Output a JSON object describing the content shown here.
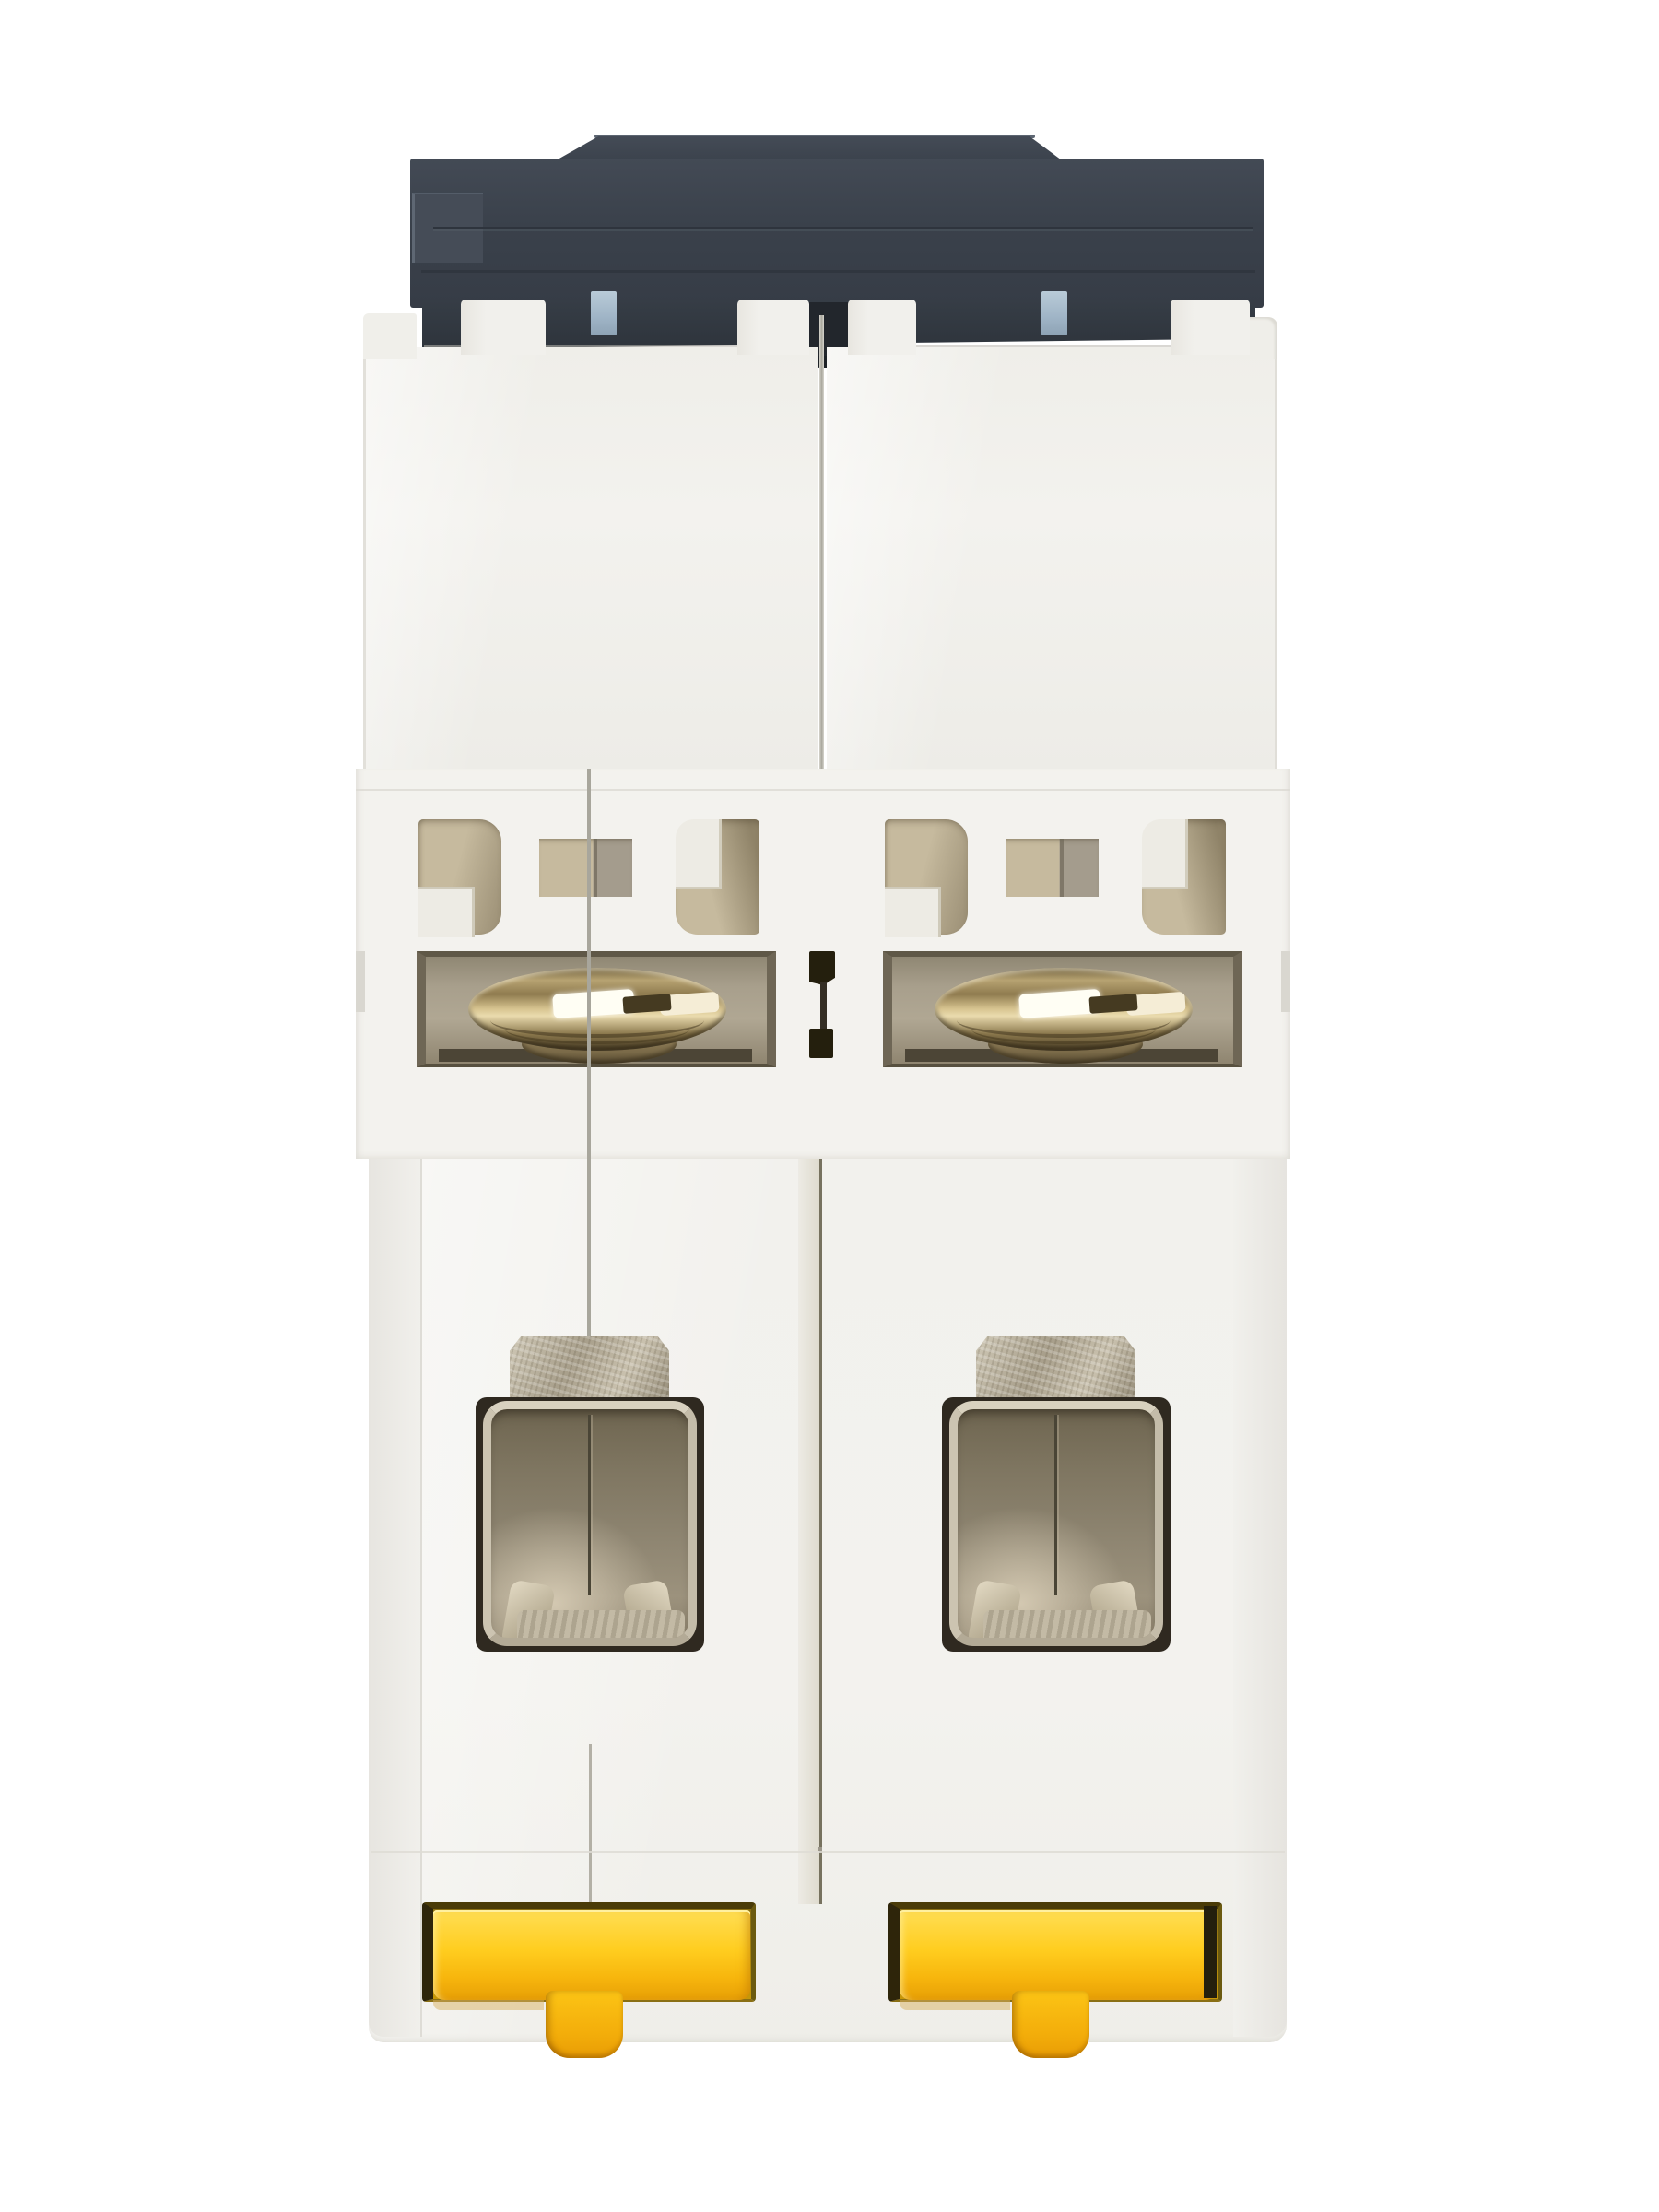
{
  "subject": "Product photograph of a two-pole miniature circuit breaker viewed from the bottom, showing the dark rear cap, white molded twin-pole body, terminal screws, cable clamp openings and yellow DIN-rail clips on a white background",
  "object": {
    "type": "miniature-circuit-breaker",
    "poles": 2,
    "view": "bottom",
    "parts": [
      "rear-cap-dark-housing",
      "cap-top-slab",
      "cap-lower-band",
      "center-divider-tab",
      "blue-latch-tab-left",
      "blue-latch-tab-right",
      "upper-white-body-pole-1",
      "upper-white-body-pole-2",
      "vent-window-row-pole-1",
      "vent-window-row-pole-2",
      "terminal-screw-pole-1",
      "terminal-screw-pole-2",
      "cable-clamp-opening-pole-1",
      "cable-clamp-opening-pole-2",
      "din-rail-clip-pole-1",
      "din-rail-clip-pole-2"
    ]
  },
  "palette": {
    "bg": "#ffffff",
    "white_base": "#f3f2ee",
    "white_light": "#f1f0ec",
    "seam": "#a8a69c",
    "channel": "#ddd9cc",
    "channel_line": "#77725f",
    "cap_face": "#3a414b",
    "cap_top": "#444b56",
    "cap_band": "#2e343c",
    "cap_tab_dark": "#22262c",
    "cap_highlight": "#5d6672",
    "blue_tab": "#9fb4c6",
    "khaki_light": "#c6ba9e",
    "khaki_dark": "#9a8e74",
    "ledge_white": "#edebe4",
    "recess_bg": "#a89f8c",
    "recess_wall": "#5f5847",
    "bronze_light": "#eadbae",
    "bronze_mid": "#8f7b4f",
    "slot_dark": "#453a21",
    "metal_tab": "#a89f8b",
    "opening_top": "#6e6550",
    "surround_dark": "#2f2920",
    "claw_light": "#e3dac4",
    "yellow_main": "#ffcd1f",
    "yellow_light": "#ffde55",
    "yellow_deep": "#c79708",
    "yellow_shadow": "#e89c05",
    "olive_black": "#241f0d"
  }
}
